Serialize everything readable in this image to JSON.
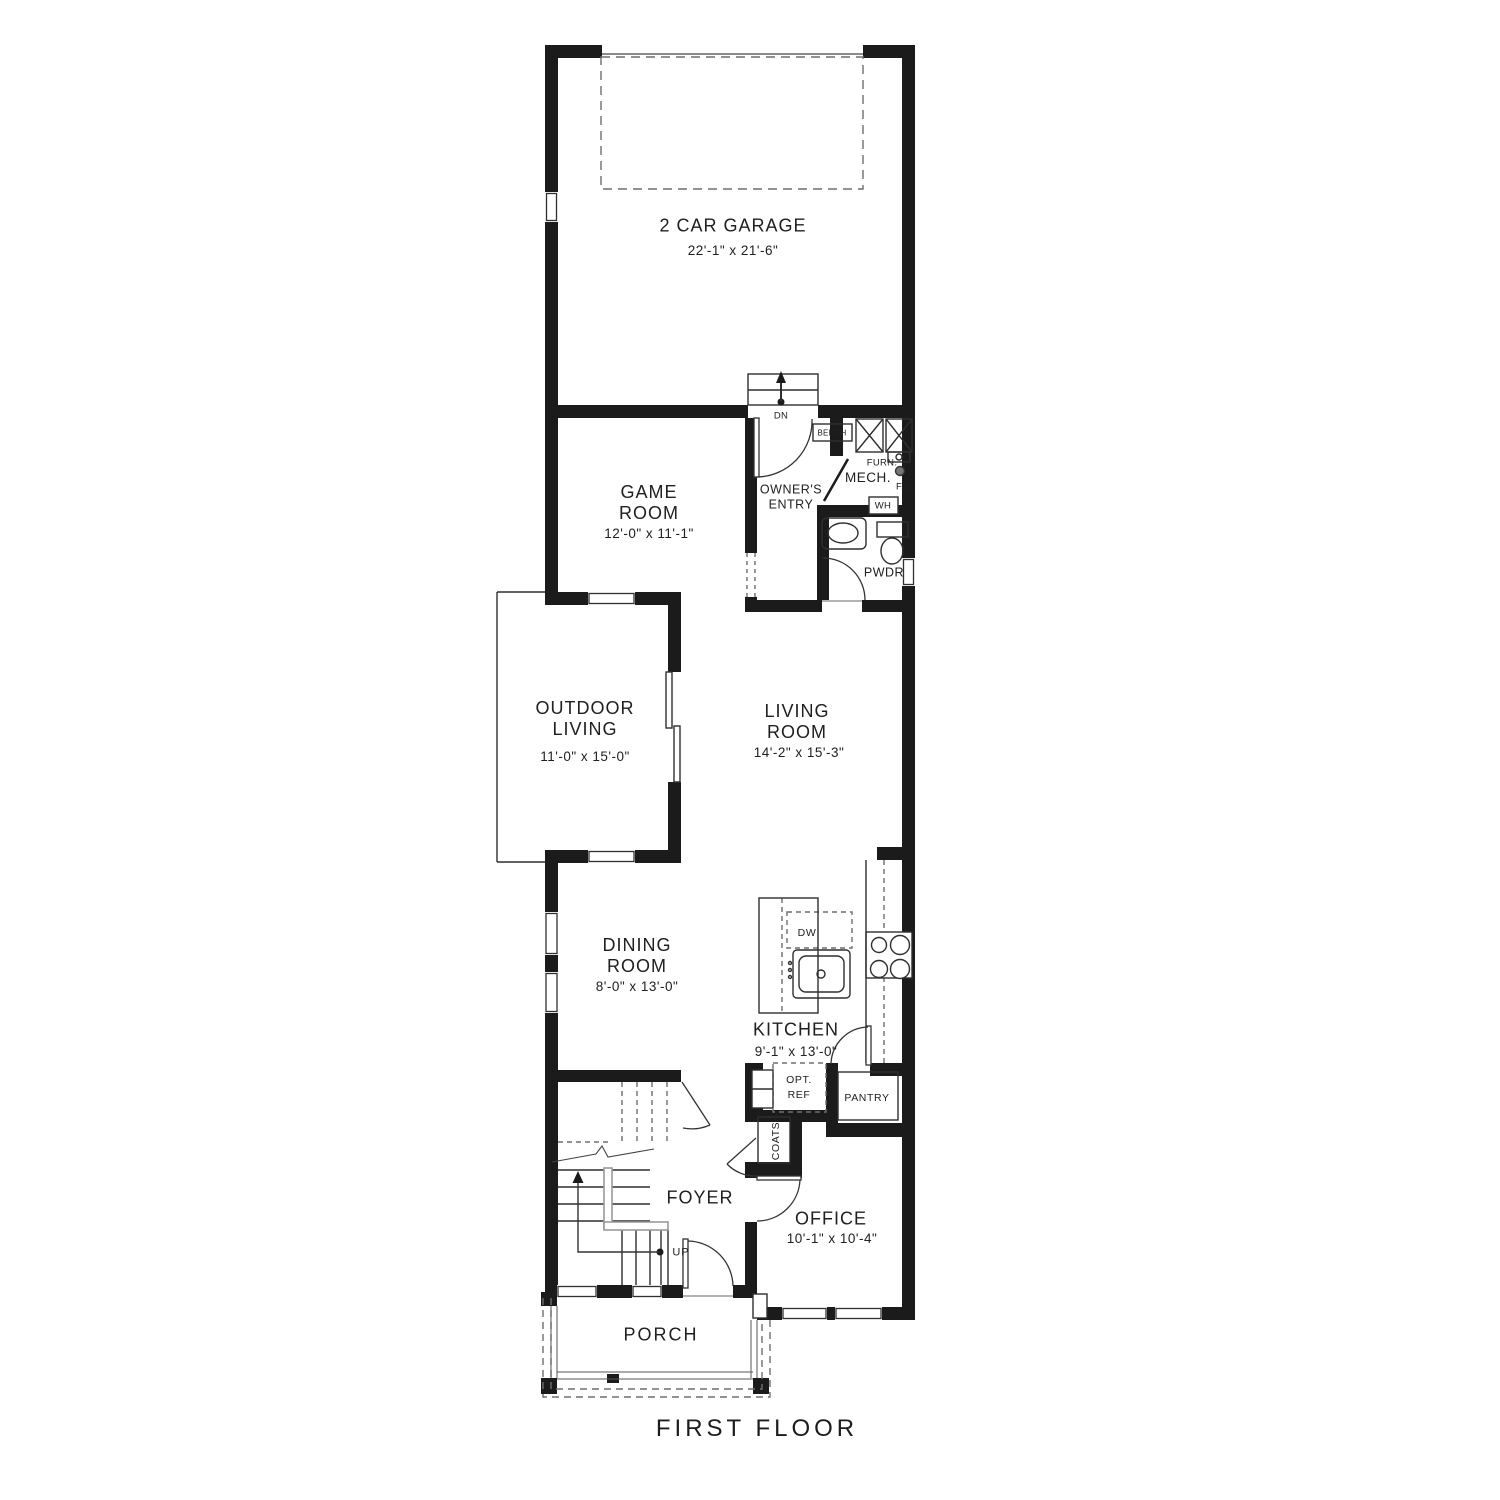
{
  "title": "FIRST FLOOR",
  "colors": {
    "wall": "#1b1b1b",
    "line": "#2f2f2f",
    "dash": "#6e6e6e",
    "gray": "#9a9a9a"
  },
  "rooms": {
    "garage": {
      "label": "2 CAR GARAGE",
      "dims": "22'-1\" x 21'-6\""
    },
    "game_room": {
      "label": "GAME ROOM",
      "dims": "12'-0\" x 11'-1\""
    },
    "owners_entry": {
      "label": "OWNER'S ENTRY"
    },
    "mech": {
      "label": "MECH."
    },
    "pwdr": {
      "label": "PWDR"
    },
    "outdoor_living": {
      "label": "OUTDOOR LIVING",
      "dims": "11'-0\" x 15'-0\""
    },
    "living_room": {
      "label": "LIVING ROOM",
      "dims": "14'-2\" x 15'-3\""
    },
    "dining_room": {
      "label": "DINING ROOM",
      "dims": "8'-0\" x 13'-0\""
    },
    "kitchen": {
      "label": "KITCHEN",
      "dims": "9'-1\" x 13'-0\""
    },
    "foyer": {
      "label": "FOYER"
    },
    "office": {
      "label": "OFFICE",
      "dims": "10'-1\" x 10'-4\""
    },
    "porch": {
      "label": "PORCH"
    },
    "pantry": {
      "label": "PANTRY"
    }
  },
  "annotations": {
    "dn": "DN",
    "up": "UP",
    "bench": "BENCH",
    "furn": "FURN.",
    "fd": "F.D.",
    "wh": "WH",
    "dw": "DW",
    "opt_ref_line1": "OPT.",
    "opt_ref_line2": "REF",
    "coats": "COATS"
  }
}
